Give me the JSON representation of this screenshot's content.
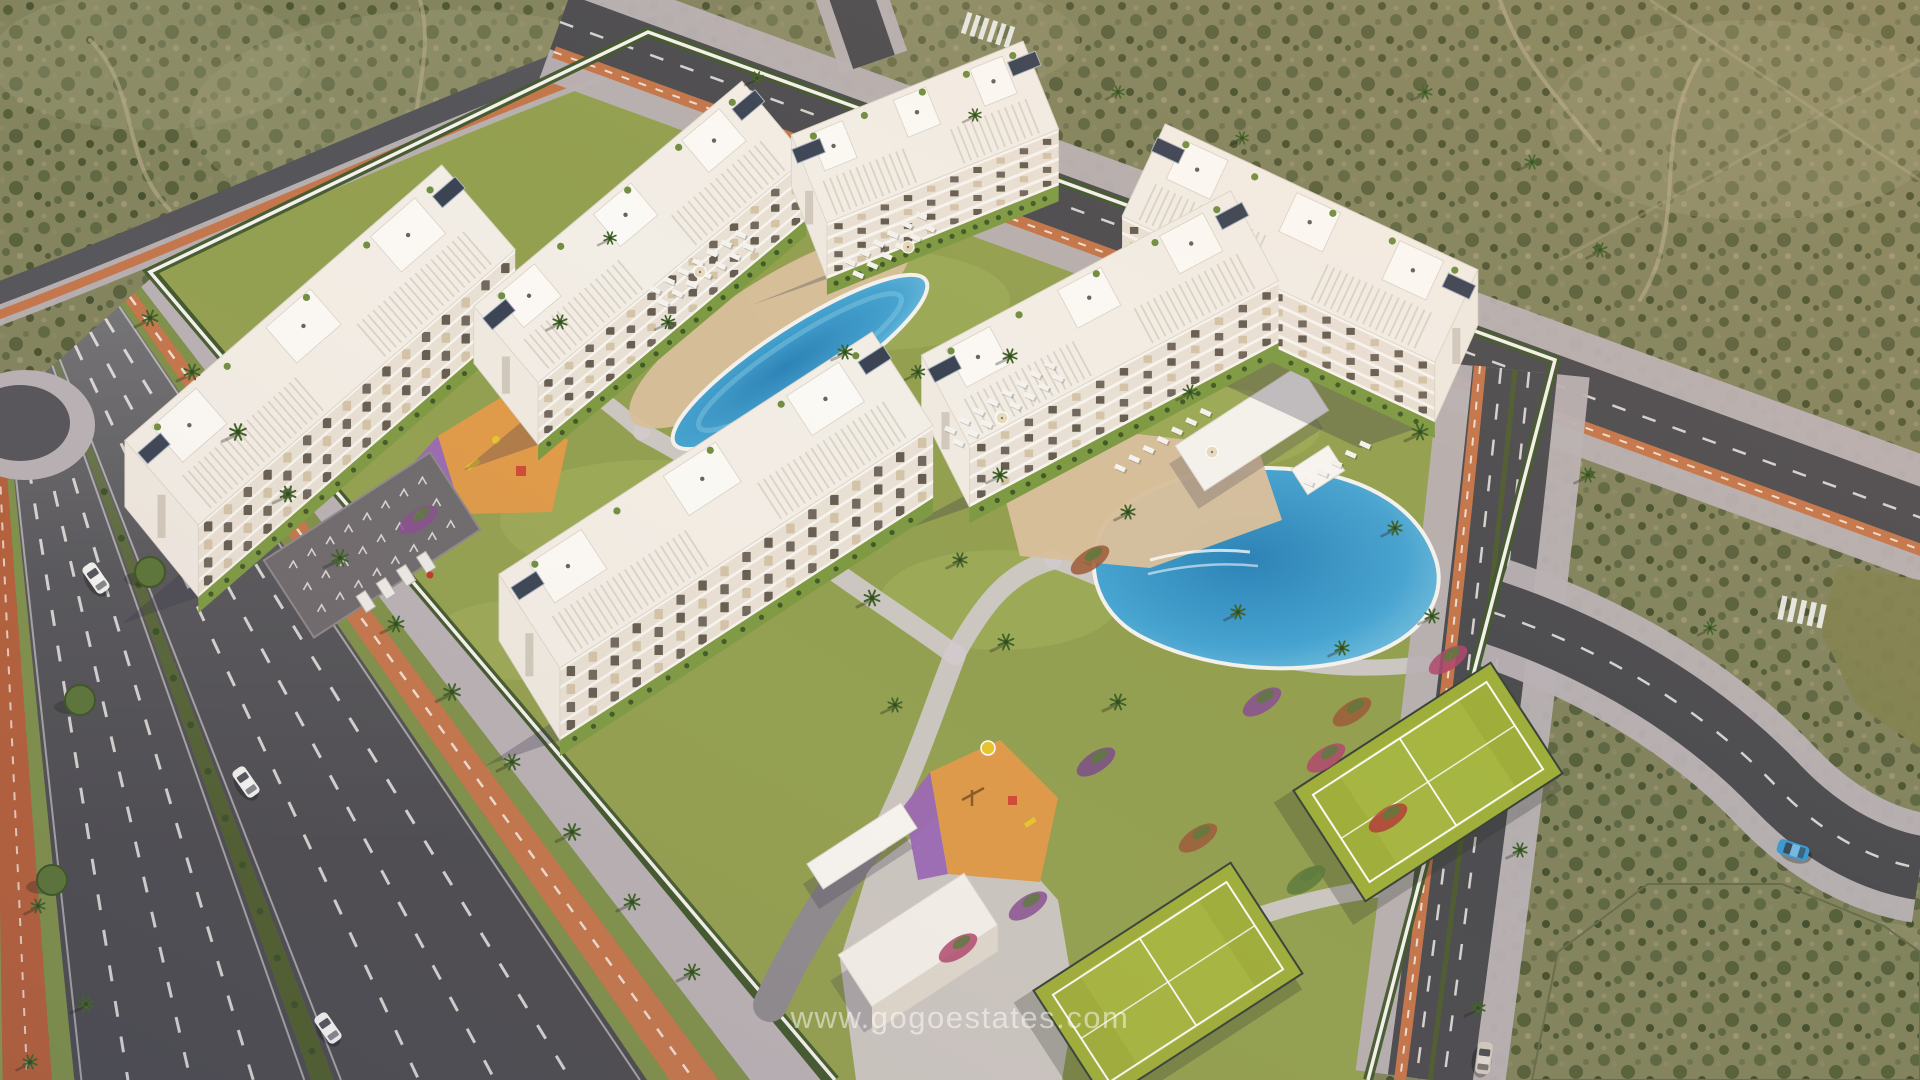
{
  "scene": {
    "kind": "aerial-architectural-render",
    "description": "Aerial 3D render of a white apartment-complex resort surrounded by roads and scrubland",
    "objects": [
      "apartment-building x6",
      "community-pool",
      "lagoon-pool",
      "sun-loungers",
      "parasols",
      "tennis-court x2",
      "playground x2",
      "bicycle-parking",
      "entrance-canopy",
      "entrance-building",
      "pool-pavilion",
      "perimeter-wall",
      "palm-trees",
      "avenue",
      "cycle-lane",
      "cars",
      "scrubland"
    ]
  },
  "watermark": {
    "text": "www.gogoestates.com"
  },
  "palette": {
    "scrub_base": "#82845e",
    "scrub_dark": "#545e38",
    "scrub_light": "#a19b78",
    "asphalt": "#4c4c50",
    "asphalt_light": "#66666c",
    "lane_mark": "#eceae6",
    "bike_path": "#c4764b",
    "bike_brick": "#b5603a",
    "bike_dash": "#f2e9e0",
    "sidewalk": "#b8b1b4",
    "paving": "#d2cacd",
    "driveway": "#8e8a8e",
    "lawn": "#93a050",
    "lawn_bright": "#a6b35e",
    "verge": "#7f914a",
    "verge2": "#8b9752",
    "hedge": "#41582e",
    "hedge_median": "#4f5e2e",
    "bush": "#384f28",
    "pool_deep": "#2d83b6",
    "pool_mid": "#46a3d0",
    "pool_light": "#8fd0e6",
    "deck_sand": "#d8bf9c",
    "court_green": "#9fae3b",
    "court_green_light": "#aab944",
    "court_line": "#ffffff",
    "fence": "#39443a",
    "play_orange": "#df9a49",
    "play_purple": "#9a68b5",
    "equip_yellow": "#e6c430",
    "equip_red": "#cf4a36",
    "building_white": "#f2ede5",
    "building_face": "#e8e0d4",
    "slab_white": "#f7f4ef",
    "window_dark": "#5f564a",
    "window_tan": "#d2c1a4",
    "window_mid": "#6b6156",
    "roof_line": "#d6cfc2",
    "solar": "#3b4454",
    "plant_green": "#6f8f3f",
    "palm_green": "#3f6228",
    "palm_trunk": "#8a6f4e",
    "tree_round": "#5b7539",
    "wall_white": "#f4f1ec",
    "shadow": "rgba(50,46,72,0.28)",
    "car_white": "#f2f2f0",
    "car_blue": "#3a9ad2",
    "car_silver": "#cfc8bd"
  },
  "buildings": [
    {
      "id": "b1",
      "cx": 320,
      "cy": 345,
      "angle": -41,
      "length": 420,
      "width": 112,
      "facade": 72,
      "floors": 4
    },
    {
      "id": "b2",
      "cx": 640,
      "cy": 232,
      "angle": -40,
      "length": 350,
      "width": 100,
      "facade": 62,
      "floors": 4
    },
    {
      "id": "b3",
      "cx": 925,
      "cy": 132,
      "angle": -22,
      "length": 250,
      "width": 95,
      "facade": 56,
      "floors": 4
    },
    {
      "id": "b4",
      "cx": 1300,
      "cy": 243,
      "angle": 25,
      "length": 345,
      "width": 102,
      "facade": 60,
      "floors": 4
    },
    {
      "id": "b5",
      "cx": 1100,
      "cy": 318,
      "angle": -28,
      "length": 350,
      "width": 102,
      "facade": 62,
      "floors": 4
    },
    {
      "id": "b6",
      "cx": 716,
      "cy": 500,
      "angle": -33,
      "length": 445,
      "width": 112,
      "facade": 72,
      "floors": 4
    }
  ],
  "courts": [
    {
      "id": "tennis-court-1",
      "cx": 1428,
      "cy": 782,
      "angle": -33,
      "length": 235,
      "width": 132
    },
    {
      "id": "tennis-court-2",
      "cx": 1168,
      "cy": 982,
      "angle": -33,
      "length": 235,
      "width": 132
    }
  ],
  "pools": [
    {
      "id": "community-pool",
      "cx": 800,
      "cy": 362
    },
    {
      "id": "lagoon-pool",
      "cx": 1270,
      "cy": 565
    }
  ],
  "cars": [
    {
      "label": "white-hatchback",
      "x": 96,
      "y": 578,
      "angle": -35,
      "color": "car_white"
    },
    {
      "label": "white-sedan",
      "x": 246,
      "y": 782,
      "angle": -35,
      "color": "car_white"
    },
    {
      "label": "white-suv",
      "x": 328,
      "y": 1028,
      "angle": -35,
      "color": "car_white"
    },
    {
      "label": "beige-sedan",
      "x": 1484,
      "y": 1058,
      "angle": 7,
      "color": "car_silver"
    },
    {
      "label": "blue-convertible",
      "x": 1793,
      "y": 850,
      "angle": -72,
      "color": "car_blue"
    }
  ],
  "parking": {
    "bike_rack_rows": 3,
    "bike_racks_per_row": 8,
    "parked_cars": 4
  },
  "lounger_clusters": [
    {
      "x": 655,
      "y": 290,
      "angle": -33,
      "rows": 2,
      "cols": 7
    },
    {
      "x": 850,
      "y": 262,
      "angle": -33,
      "rows": 2,
      "cols": 6
    },
    {
      "x": 950,
      "y": 430,
      "angle": -33,
      "rows": 2,
      "cols": 8
    },
    {
      "x": 1120,
      "y": 468,
      "angle": -33,
      "rows": 1,
      "cols": 7
    },
    {
      "x": 1308,
      "y": 482,
      "angle": -33,
      "rows": 1,
      "cols": 5
    }
  ],
  "parasols": [
    [
      700,
      272
    ],
    [
      908,
      247
    ],
    [
      1002,
      418
    ],
    [
      1212,
      452
    ]
  ],
  "palms": [
    [
      150,
      318,
      1
    ],
    [
      192,
      372,
      1
    ],
    [
      238,
      432,
      1.05
    ],
    [
      288,
      494,
      1
    ],
    [
      340,
      558,
      1.05
    ],
    [
      396,
      624,
      1
    ],
    [
      452,
      692,
      1.05
    ],
    [
      512,
      762,
      1
    ],
    [
      572,
      832,
      1.05
    ],
    [
      632,
      902,
      1
    ],
    [
      692,
      972,
      1
    ],
    [
      38,
      906,
      0.9
    ],
    [
      86,
      1004,
      1
    ],
    [
      30,
      1062,
      0.9
    ],
    [
      560,
      322,
      0.9
    ],
    [
      610,
      238,
      0.8
    ],
    [
      845,
      352,
      0.9
    ],
    [
      1010,
      356,
      0.9
    ],
    [
      1190,
      392,
      0.9
    ],
    [
      1420,
      432,
      1
    ],
    [
      1000,
      475,
      0.9
    ],
    [
      872,
      598,
      1
    ],
    [
      1006,
      642,
      1
    ],
    [
      1118,
      702,
      1
    ],
    [
      1238,
      612,
      0.9
    ],
    [
      1342,
      648,
      0.9
    ],
    [
      895,
      705,
      0.9
    ],
    [
      960,
      560,
      0.9
    ],
    [
      757,
      78,
      0.8
    ],
    [
      975,
      115,
      0.8
    ],
    [
      1118,
      92,
      0.8
    ],
    [
      1242,
      138,
      0.8
    ],
    [
      1425,
      92,
      0.9
    ],
    [
      1532,
      162,
      0.9
    ],
    [
      1600,
      250,
      0.9
    ],
    [
      1588,
      475,
      0.9
    ],
    [
      1520,
      850,
      0.9
    ],
    [
      1478,
      1008,
      0.9
    ],
    [
      1710,
      628,
      0.8
    ],
    [
      1128,
      512,
      0.9
    ],
    [
      1395,
      528,
      0.9
    ],
    [
      1432,
      616,
      0.9
    ],
    [
      668,
      322,
      0.85
    ],
    [
      918,
      372,
      0.85
    ]
  ],
  "round_trees": [
    [
      80,
      700
    ],
    [
      150,
      572
    ],
    [
      52,
      880
    ],
    [
      205,
      448
    ]
  ],
  "flowerbeds": [
    [
      1262,
      702
    ],
    [
      1326,
      758
    ],
    [
      1198,
      838
    ],
    [
      1306,
      880
    ],
    [
      1096,
      762
    ],
    [
      1388,
      818
    ],
    [
      1028,
      906
    ],
    [
      958,
      948
    ],
    [
      1352,
      712
    ],
    [
      250,
      378
    ],
    [
      342,
      442
    ],
    [
      300,
      330
    ],
    [
      418,
      520
    ],
    [
      1448,
      660
    ],
    [
      1090,
      560
    ]
  ]
}
